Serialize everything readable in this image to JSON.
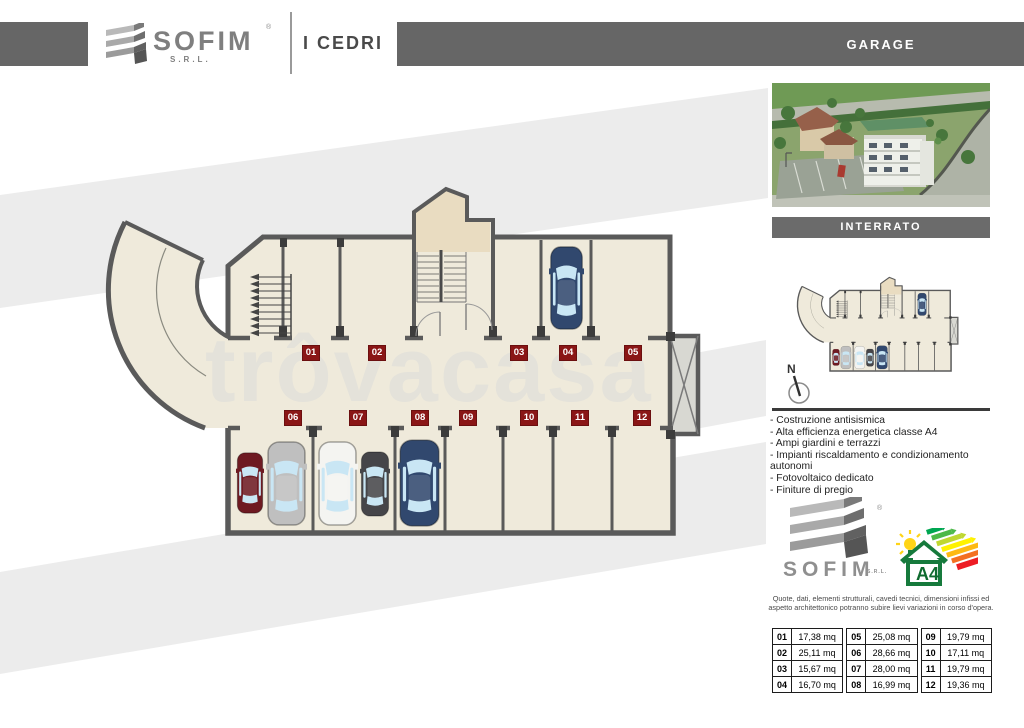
{
  "header": {
    "brand": "SOFIM",
    "brand_suffix": "S.R.L.",
    "registered_mark": "®",
    "project": "I CEDRI",
    "page_label": "GARAGE"
  },
  "sidebar": {
    "level_label": "INTERRATO",
    "compass_label": "N",
    "features": [
      "- Costruzione antisismica",
      "- Alta efficienza energetica classe A4",
      "- Ampi giardini e terrazzi",
      "- Impianti riscaldamento e condizionamento autonomi",
      "- Fotovoltaico dedicato",
      "- Finiture di pregio"
    ],
    "footer_brand": "SOFIM",
    "footer_brand_suffix": "S.R.L.",
    "registered_mark": "®",
    "energy_class": "A4",
    "disclaimer": "Quote, dati, elementi strutturali, cavedi tecnici, dimensioni infissi ed aspetto architettonico potranno subire lievi variazioni in corso d'opera."
  },
  "watermark": "trôvacasa",
  "plan": {
    "badges": [
      {
        "label": "01"
      },
      {
        "label": "02"
      },
      {
        "label": "03"
      },
      {
        "label": "04"
      },
      {
        "label": "05"
      },
      {
        "label": "06"
      },
      {
        "label": "07"
      },
      {
        "label": "08"
      },
      {
        "label": "09"
      },
      {
        "label": "10"
      },
      {
        "label": "11"
      },
      {
        "label": "12"
      }
    ]
  },
  "table": {
    "groups": [
      {
        "rows": [
          {
            "id": "01",
            "area": "17,38 mq"
          },
          {
            "id": "02",
            "area": "25,11 mq"
          },
          {
            "id": "03",
            "area": "15,67 mq"
          },
          {
            "id": "04",
            "area": "16,70 mq"
          }
        ]
      },
      {
        "rows": [
          {
            "id": "05",
            "area": "25,08 mq"
          },
          {
            "id": "06",
            "area": "28,66 mq"
          },
          {
            "id": "07",
            "area": "28,00 mq"
          },
          {
            "id": "08",
            "area": "16,99 mq"
          }
        ]
      },
      {
        "rows": [
          {
            "id": "09",
            "area": "19,79 mq"
          },
          {
            "id": "10",
            "area": "17,11 mq"
          },
          {
            "id": "11",
            "area": "19,79 mq"
          },
          {
            "id": "12",
            "area": "19,36 mq"
          }
        ]
      }
    ]
  }
}
